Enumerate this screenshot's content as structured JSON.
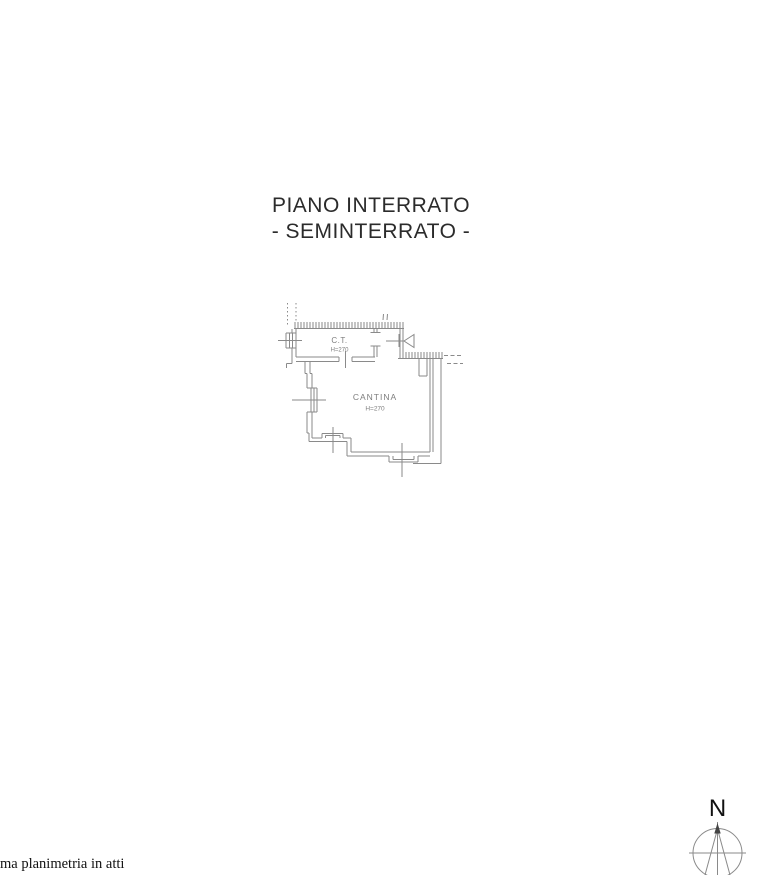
{
  "page": {
    "title_line1": "PIANO INTERRATO",
    "title_line2": "- SEMINTERRATO -",
    "footer_note": "ma planimetria in atti"
  },
  "plan": {
    "rooms": [
      {
        "name": "C.T.",
        "height_label": "H=270"
      },
      {
        "name": "CANTINA",
        "height_label": "H=270"
      }
    ]
  },
  "compass": {
    "label": "N"
  },
  "colors": {
    "line": "#8a8a8a",
    "room_label": "#7d7d7d",
    "title": "#2b2b2b",
    "background": "#ffffff"
  }
}
